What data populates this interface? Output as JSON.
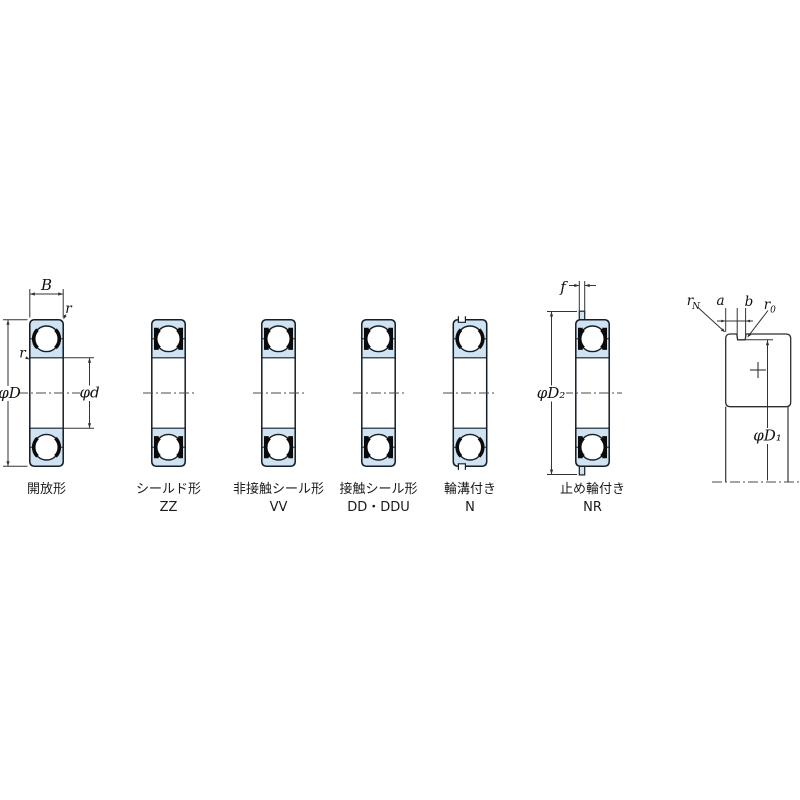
{
  "figure": {
    "description": "ball bearing type cross-sections",
    "bearings": [
      {
        "name": "開放形",
        "code": ""
      },
      {
        "name": "シールド形",
        "code": "ZZ"
      },
      {
        "name": "非接触シール形",
        "code": "VV"
      },
      {
        "name": "接触シール形",
        "code": "DD・DDU"
      },
      {
        "name": "輪溝付き",
        "code": "N"
      },
      {
        "name": "止め輪付き",
        "code": "NR"
      }
    ],
    "dims": {
      "B": "B",
      "r_outer": "r",
      "r_inner": "r",
      "phiD": "φD",
      "phid": "φd",
      "f": "f",
      "phiD2": "φD₂",
      "phiD1": "φD₁",
      "a": "a",
      "b": "b",
      "rN_base": "r",
      "rN_sub": "N",
      "r0_base": "r",
      "r0_sub": "0"
    },
    "colors": {
      "ring_fill": "#cfe3f2",
      "outline": "#141e28",
      "dim_line": "#333333"
    }
  }
}
